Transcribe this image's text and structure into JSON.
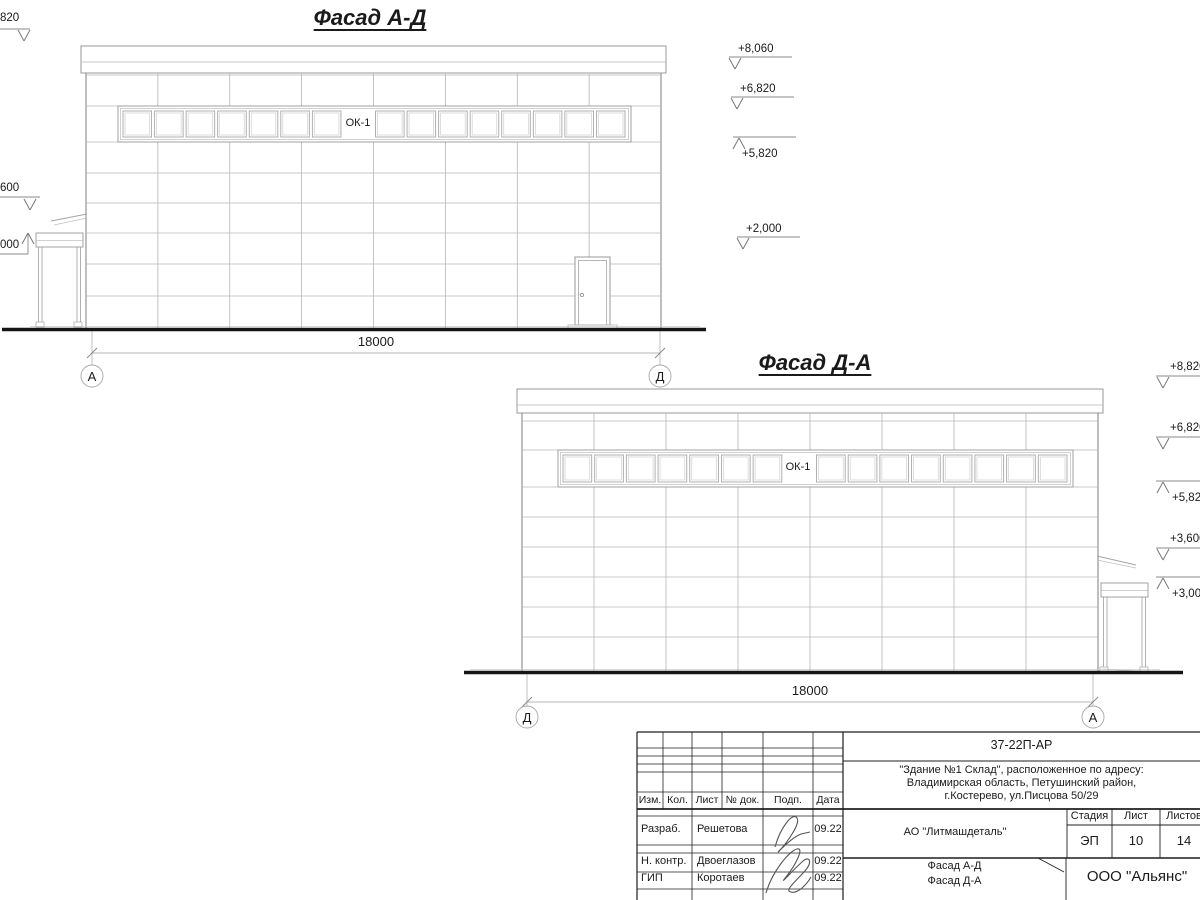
{
  "drawing": {
    "facade_ad": {
      "title": "Фасад А-Д",
      "window_label": "ОК-1",
      "dimension": "18000",
      "axis_left": "А",
      "axis_right": "Д",
      "left_marks": [
        "820",
        "600",
        "000"
      ],
      "right_marks": [
        "+8,060",
        "+6,820",
        "+5,820",
        "+2,000"
      ]
    },
    "facade_da": {
      "title": "Фасад Д-А",
      "window_label": "ОК-1",
      "dimension": "18000",
      "axis_left": "Д",
      "axis_right": "А",
      "right_marks": [
        "+8,820",
        "+6,820",
        "+5,820",
        "+3,600",
        "+3,000"
      ]
    }
  },
  "title_block": {
    "doc_number": "37-22П-АР",
    "address_lines": [
      "\"Здание №1 Склад\", расположенное по адресу:",
      "Владимирская область, Петушинский район,",
      "г.Костерево, ул.Писцова 50/29"
    ],
    "company": "АО \"Литмашдеталь\"",
    "header": [
      "Изм.",
      "Кол.",
      "Лист",
      "№ док.",
      "Подп.",
      "Дата"
    ],
    "rows": [
      {
        "role": "Разраб.",
        "name": "Решетова",
        "date": "09.22"
      },
      {
        "role": "Н. контр.",
        "name": "Двоеглазов",
        "date": "09.22"
      },
      {
        "role": "ГИП",
        "name": "Коротаев",
        "date": "09.22"
      }
    ],
    "stage_label": "Стадия",
    "sheet_label": "Лист",
    "sheets_label": "Листов",
    "stage": "ЭП",
    "sheet": "10",
    "sheets": "14",
    "doc_title_lines": [
      "Фасад А-Д",
      "Фасад Д-А"
    ],
    "org": "ООО \"Альянс\"",
    "line_color": "#1f1f1f"
  },
  "colors": {
    "drawing_line": "#a8a8a8",
    "ground_line": "#151515"
  }
}
